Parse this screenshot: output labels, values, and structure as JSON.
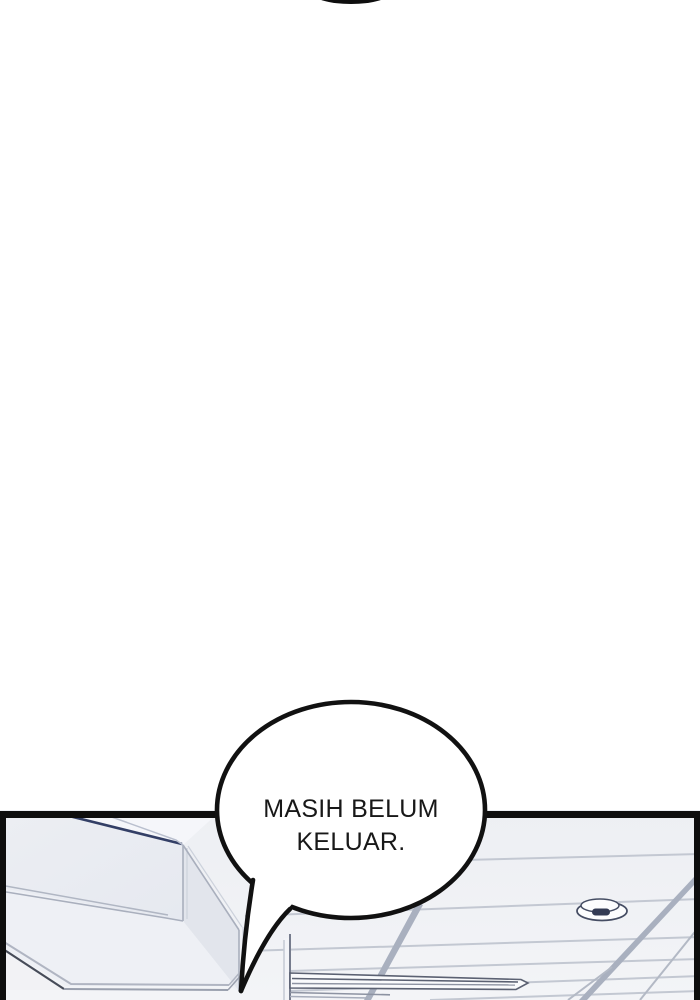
{
  "page": {
    "background_color": "#ffffff"
  },
  "panel": {
    "border_color": "#0e0e0e",
    "ceiling_top_color": "#edeff3",
    "ceiling_bottom_color": "#f3f4f7",
    "seam_color": "#c3c8d2",
    "runner_color": "#a9b0bf",
    "beam_face_color": "#e9ebf1",
    "beam_accent_color": "#333f66",
    "fixture_outline_color": "#5b6172",
    "detector_outline_color": "#454d63"
  },
  "speech_bubble": {
    "line1": "MASIH BELUM",
    "line2": "KELUAR.",
    "fill": "#ffffff",
    "stroke": "#111111",
    "text_color": "#181818"
  }
}
